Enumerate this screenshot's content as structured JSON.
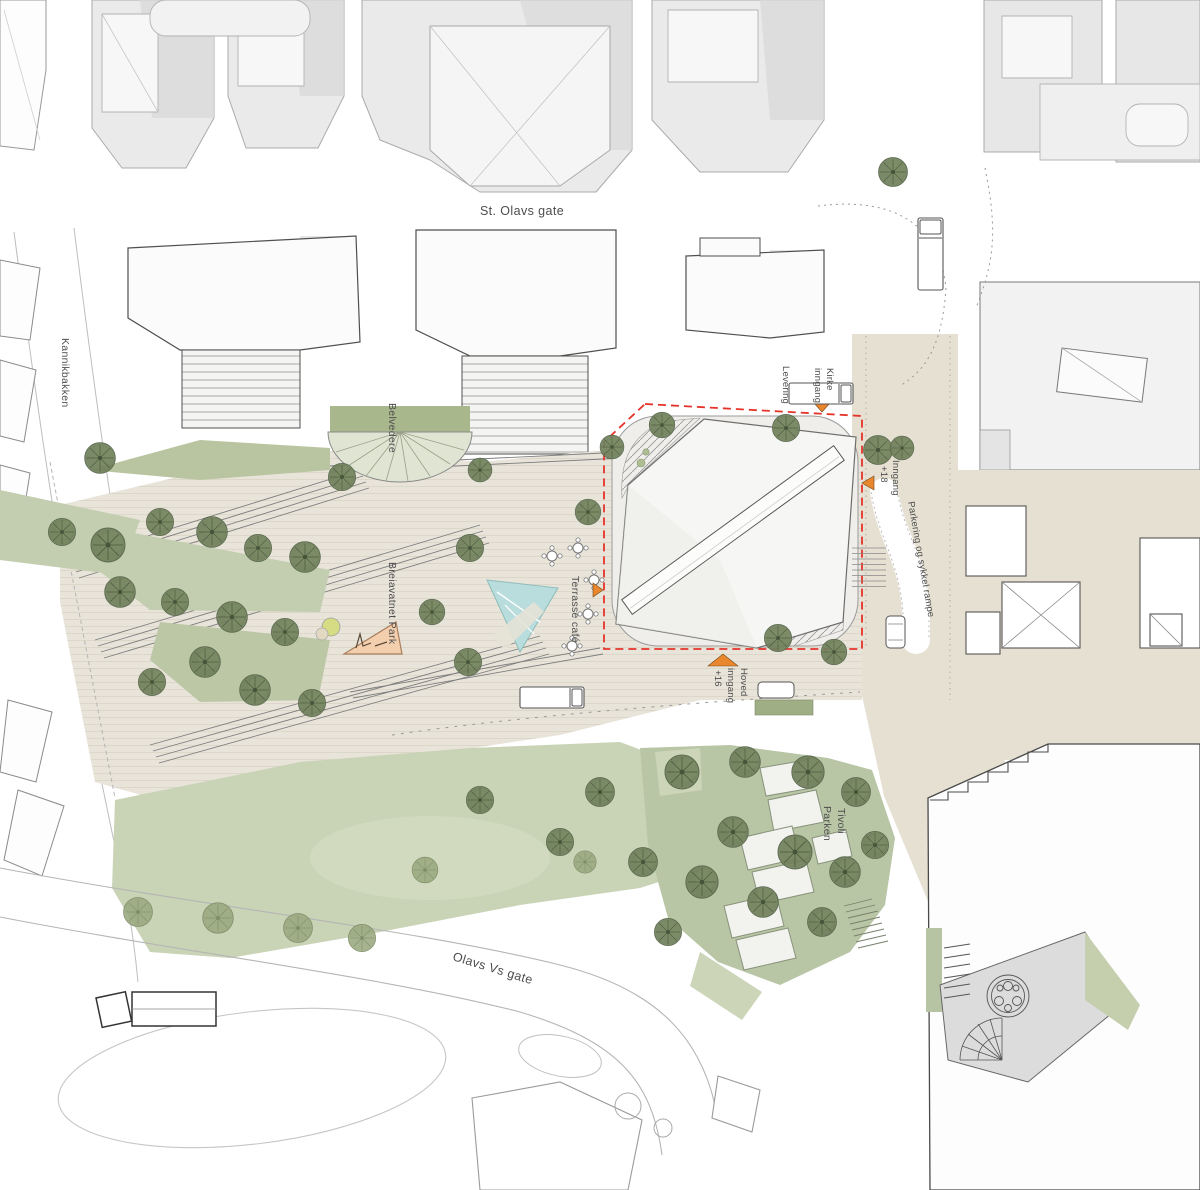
{
  "title": "Architectural site plan",
  "labels": {
    "st_olavs_gate": "St. Olavs gate",
    "kannikbakken": "Kannikbakken",
    "belvedere": "Belvedere",
    "breiavatnet_park": "Breiavatnet Park",
    "terrasse_cafe": "Terrasse café",
    "levering": "Levering",
    "kirke_inngang": {
      "line1": "Kirke",
      "line2": "inngang"
    },
    "inngang_18": {
      "line1": "Inngang",
      "line2": "+18"
    },
    "parkering_rampe": "Parkering og sykkel rampe",
    "hoved_inngang": {
      "line1": "Hoved",
      "line2": "inngang",
      "line3": "+16"
    },
    "tivoli_parken": {
      "line1": "Tivoli",
      "line2": "Parken"
    },
    "olavs_vs_gate": "Olavs Vs gate"
  },
  "colors": {
    "site_boundary_dash": "#e5332a",
    "entrance_marker": "#e8872e",
    "tree_dark": "#71815c",
    "tree_light": "#9cab82",
    "lawn": "#c9d3b6",
    "tivoli_lawn": "#b9c6a6",
    "paving": "#e8e4d9",
    "street_beige": "#e5e0d2",
    "pool": "#b9dcdc",
    "context_building": "#eaeaea",
    "building_outline": "#4f4f4f",
    "label_text": "#4d4d4d"
  }
}
